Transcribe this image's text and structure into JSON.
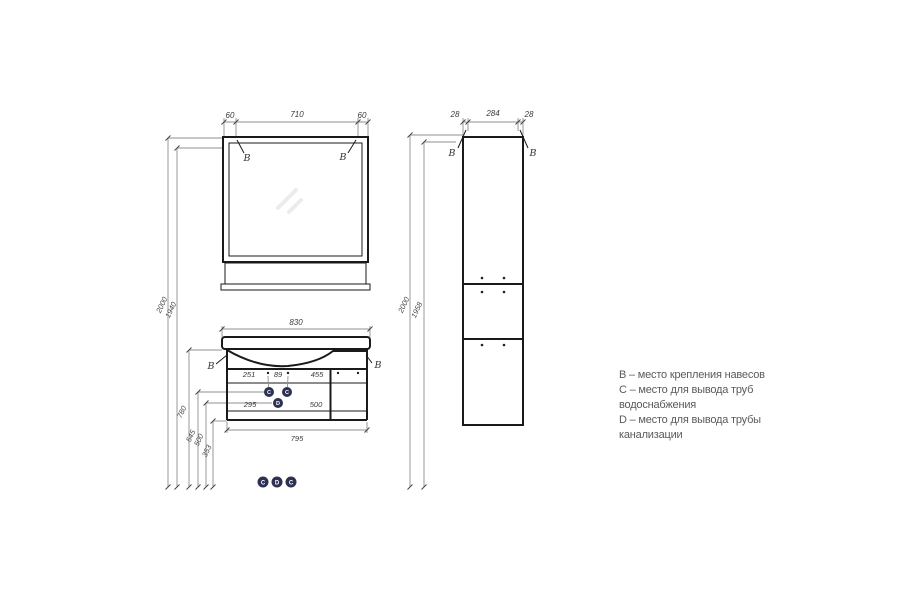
{
  "legend": {
    "line1": "B – место крепления навесов",
    "line2": "C – место для вывода труб",
    "line3": "водоснабжения",
    "line4": "D – место для вывода трубы",
    "line5": "канализации"
  },
  "mirror_view": {
    "dim_left": "60",
    "dim_width": "710",
    "dim_right": "60",
    "label_left": "B",
    "label_right": "B"
  },
  "heights_left": {
    "total": "2000",
    "mirror": "1940",
    "counter": "780",
    "water": "545",
    "drain": "500",
    "bottom": "353"
  },
  "vanity_view": {
    "dim_width_top": "830",
    "dim_row1": [
      "251",
      "89",
      "455"
    ],
    "dim_row2": [
      "295",
      "500"
    ],
    "dim_width_bottom": "795",
    "label_left": "B",
    "label_right": "B",
    "hole_markers": [
      "C",
      "C",
      "D"
    ],
    "floor_markers": [
      "C",
      "D",
      "C"
    ]
  },
  "column_view": {
    "dim_left": "28",
    "dim_width": "284",
    "dim_right": "28",
    "height_total": "2000",
    "height_body": "1958",
    "label_left": "B",
    "label_right": "B"
  },
  "colors": {
    "marker_fill": "#2d3153",
    "line": "#1a1a1a",
    "dim_line": "#8f8f8f"
  }
}
